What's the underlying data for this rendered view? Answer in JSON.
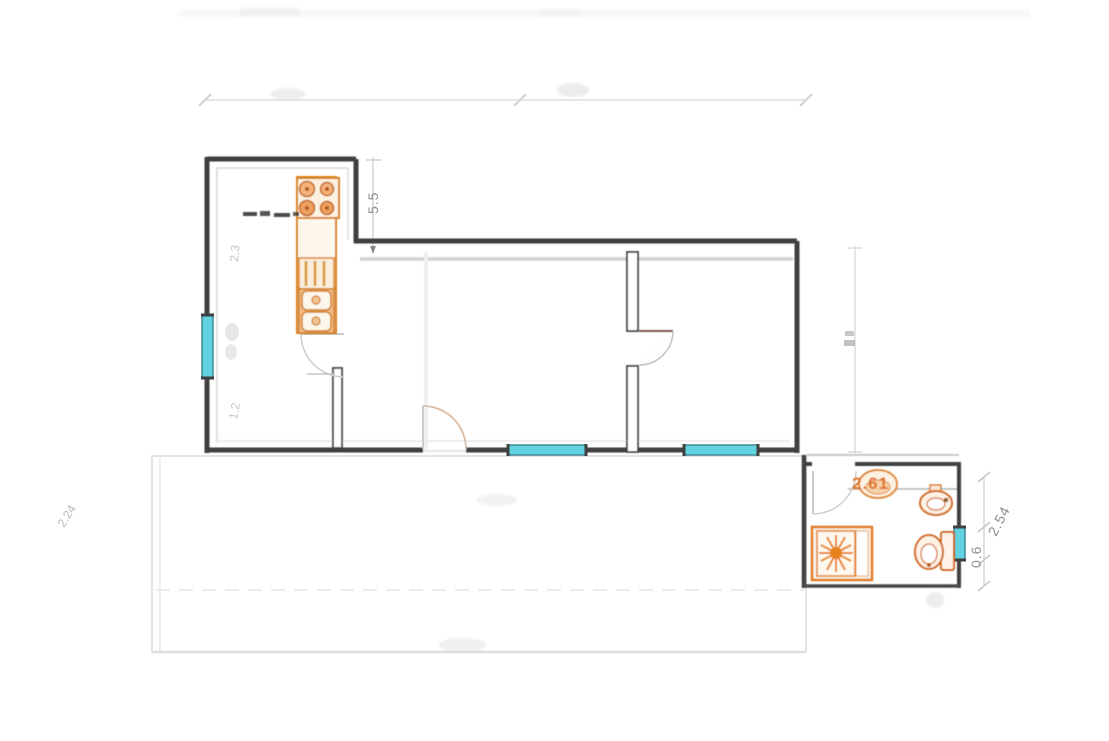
{
  "page": {
    "type": "scanned architectural floor plan",
    "background": "#ffffff"
  },
  "labels": {
    "kitchen_depth": "5.5",
    "bathroom_width": "2.61",
    "bathroom_window": "0.6",
    "bathroom_depth": "2.54",
    "kitchen_window_upper": "2.3",
    "kitchen_window_lower": "1.2",
    "terrace_left": "2.24"
  },
  "colors": {
    "walls": "#3f3f3f",
    "fixture_orange": "#d8821f",
    "window_cyan": "#62d2e0",
    "dimension_line": "#d9d9d9",
    "dimension_text": "#8e8e8e",
    "bathroom_label_orange": "#e0732c",
    "door_arc": "#c9c9c9"
  },
  "icons": {
    "kitchen": [
      "stove-4-burners-icon",
      "counter-icon",
      "drawer-cabinet-icon",
      "double-sink-icon"
    ],
    "bathroom": [
      "washbasin-icon",
      "bidet-icon",
      "toilet-with-cistern-icon",
      "shower-tray-sunburst-icon"
    ],
    "openings": [
      "window-glyph",
      "door-swing-arc"
    ]
  }
}
